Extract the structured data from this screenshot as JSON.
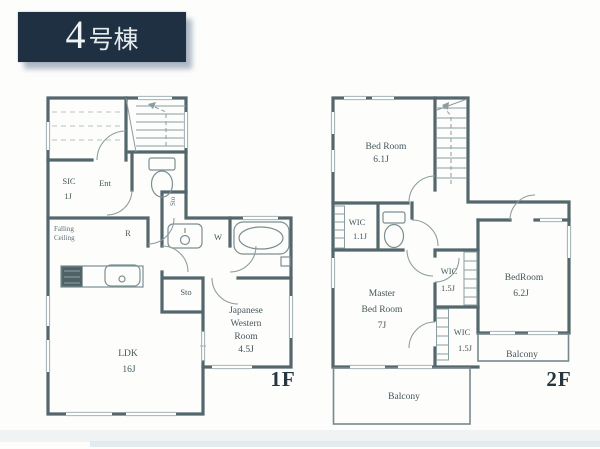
{
  "badge": {
    "number": "4",
    "suffix": "号棟"
  },
  "floor1": {
    "floor_label": "1F",
    "labels": {
      "sic_line1": "SIC",
      "sic_line2": "1J",
      "entrance": "Ent",
      "falling_line1": "Falling",
      "falling_line2": "Ceiling",
      "refrigerator": "R",
      "storage_hall": "Sto",
      "washroom": "W",
      "storage_mid": "Sto",
      "jwr_line1": "Japanese",
      "jwr_line2": "Western",
      "jwr_line3": "Room",
      "jwr_line4": "4.5J",
      "ldk_line1": "LDK",
      "ldk_line2": "16J"
    }
  },
  "floor2": {
    "floor_label": "2F",
    "labels": {
      "bedroom1_line1": "Bed Room",
      "bedroom1_line2": "6.1J",
      "wic1_line1": "WIC",
      "wic1_line2": "1.1J",
      "master_line1": "Master",
      "master_line2": "Bed Room",
      "master_line3": "7J",
      "wic2_line1": "WIC",
      "wic2_line2": "1.5J",
      "wic3_line1": "WIC",
      "wic3_line2": "1.5J",
      "bedroom2_line1": "BedRoom",
      "bedroom2_line2": "6.2J",
      "balcony_side": "Balcony",
      "balcony_main": "Balcony"
    }
  },
  "colors": {
    "wall": "#54676c",
    "thin_line": "#8fa2a5",
    "text": "#44565b",
    "badge_background": "#203043",
    "badge_text": "#eef3f4"
  }
}
